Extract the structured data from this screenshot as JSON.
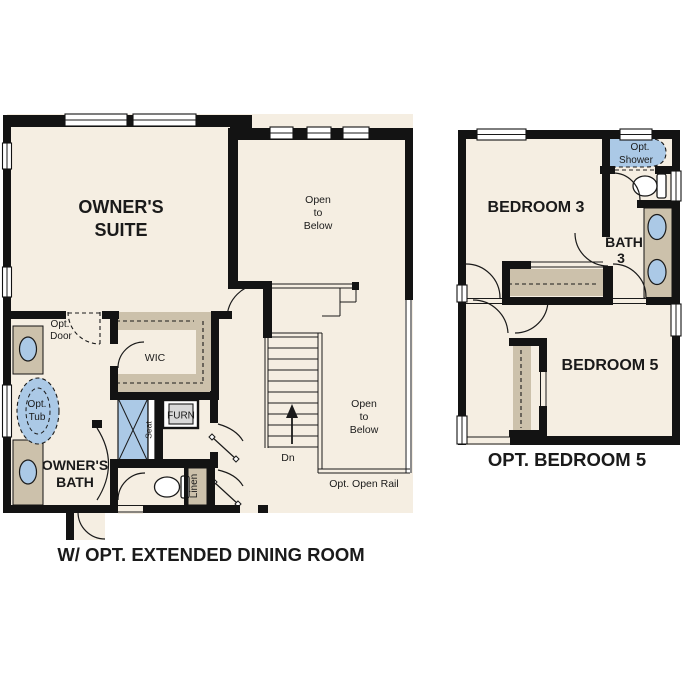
{
  "colors": {
    "background": "#ffffff",
    "floor": "#f5eee2",
    "counter_tan": "#ccc1ab",
    "fixture_blue": "#abc9e6",
    "wall_black": "#131313",
    "furnace_gray": "#d9d9d9"
  },
  "left_plan": {
    "owners_suite_line1": "OWNER'S",
    "owners_suite_line2": "SUITE",
    "open_below_upper_l1": "Open",
    "open_below_upper_l2": "to",
    "open_below_upper_l3": "Below",
    "open_below_lower_l1": "Open",
    "open_below_lower_l2": "to",
    "open_below_lower_l3": "Below",
    "wic": "WIC",
    "furn": "FURN",
    "seat": "Seat",
    "linen": "Linen",
    "opt_door_l1": "Opt.",
    "opt_door_l2": "Door",
    "opt_tub_l1": "Opt.",
    "opt_tub_l2": "Tub",
    "owners_bath_l1": "OWNER'S",
    "owners_bath_l2": "BATH",
    "stairs_dn": "Dn",
    "opt_open_rail": "Opt. Open Rail",
    "caption": "W/ OPT. EXTENDED DINING ROOM"
  },
  "right_plan": {
    "bedroom3": "BEDROOM 3",
    "bath3_l1": "BATH",
    "bath3_l2": "3",
    "opt_shower_l1": "Opt.",
    "opt_shower_l2": "Shower",
    "bedroom5": "BEDROOM 5",
    "caption": "OPT. BEDROOM 5"
  }
}
